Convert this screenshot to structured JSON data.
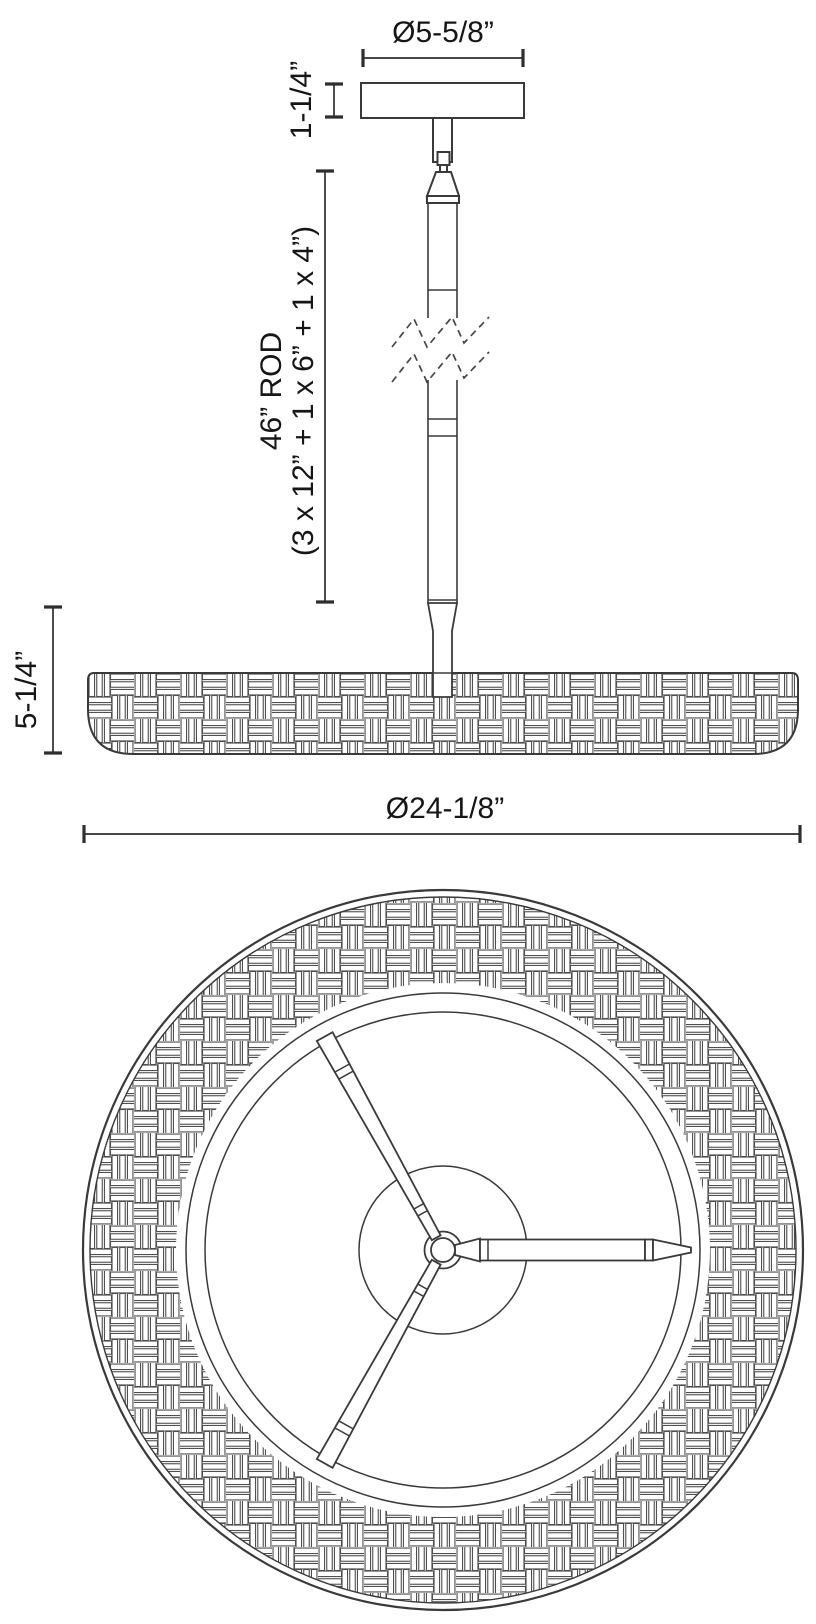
{
  "drawing": {
    "description": "pendant light fixture technical dimension drawing",
    "colors": {
      "background": "#ffffff",
      "line": "#3a3a3a",
      "pattern_line": "#4f4f4f",
      "text": "#161616"
    },
    "side_view": {
      "canopy_diameter": "Ø5-5/8”",
      "canopy_height": "1-1/4”",
      "rod_length_line1": "46” ROD",
      "rod_length_line2": "(3 x 12” + 1 x 6” + 1 x 4”)",
      "shade_height": "5-1/4”",
      "shade_diameter": "Ø24-1/8”"
    }
  }
}
